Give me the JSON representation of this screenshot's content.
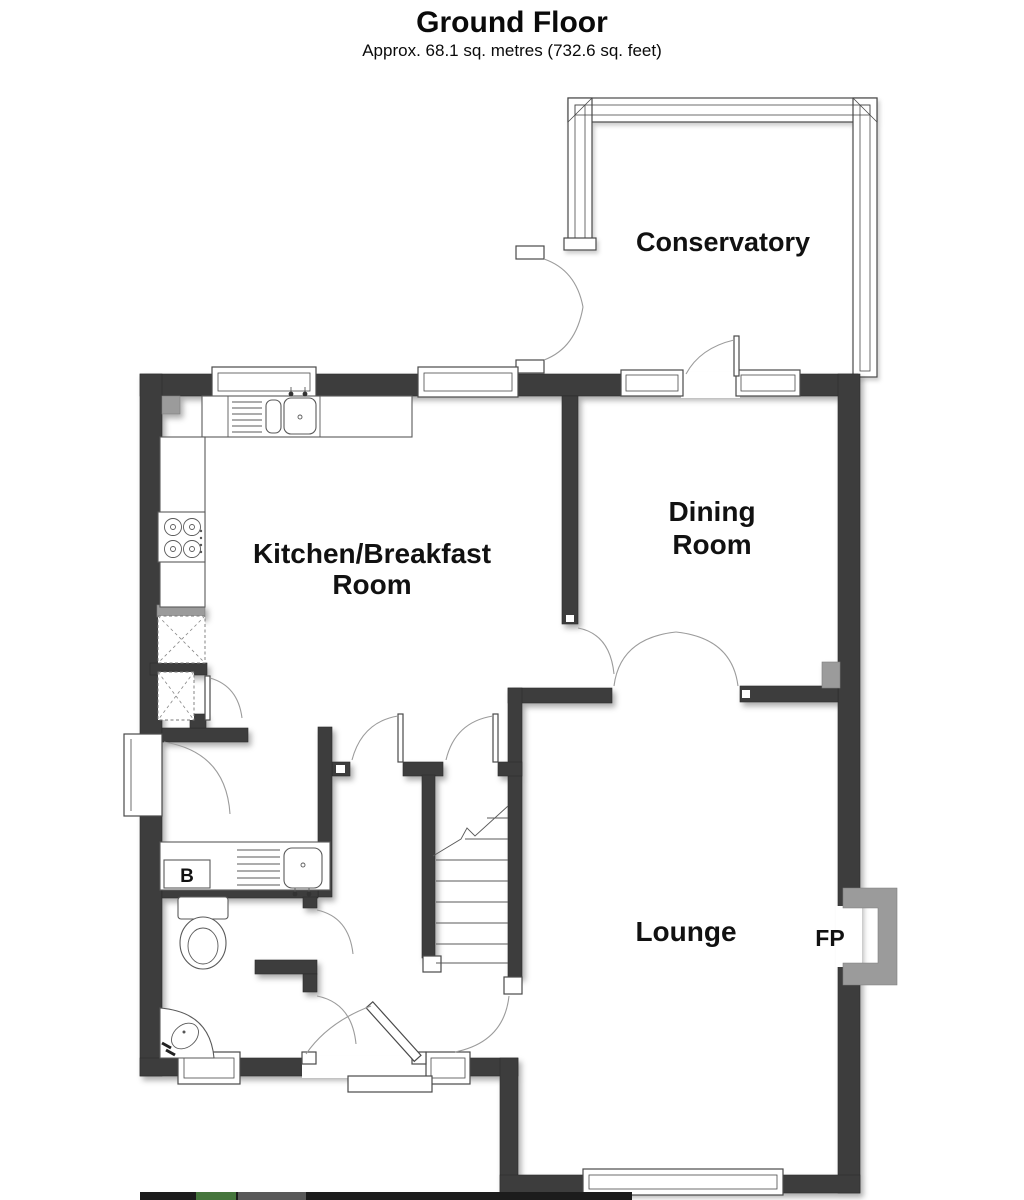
{
  "header": {
    "title": "Ground Floor",
    "subtitle": "Approx. 68.1 sq. metres (732.6 sq. feet)"
  },
  "rooms": {
    "conservatory": {
      "label": "Conservatory"
    },
    "dining_room": {
      "line1": "Dining",
      "line2": "Room"
    },
    "kitchen": {
      "line1": "Kitchen/Breakfast",
      "line2": "Room"
    },
    "lounge": {
      "label": "Lounge"
    }
  },
  "annotations": {
    "fireplace": "FP",
    "boiler": "B"
  },
  "colors": {
    "wall": "#3d3d3d",
    "wall_light": "#9b9b9b",
    "line": "#4a4a4a",
    "logo_dark": "#1c1c1c",
    "logo_green": "#45753c",
    "logo_gray": "#595959"
  }
}
